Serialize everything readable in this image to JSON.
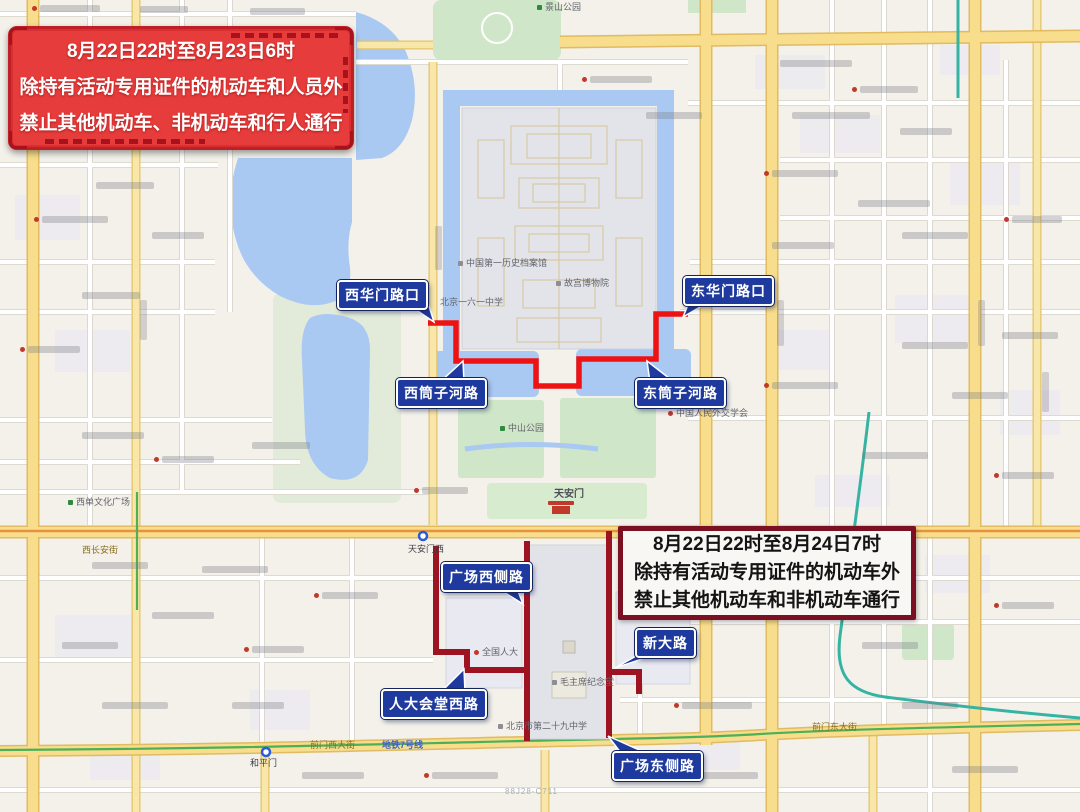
{
  "notices": {
    "red": {
      "line1": "8月22日22时至8月23日6时",
      "line2": "除持有活动专用证件的机动车和人员外",
      "line3": "禁止其他机动车、非机动车和行人通行"
    },
    "maroon": {
      "line1": "8月22日22时至8月24日7时",
      "line2": "除持有活动专用证件的机动车外",
      "line3": "禁止其他机动车和非机动车通行"
    }
  },
  "callouts": {
    "xihuamen": "西华门路口",
    "donghuamen": "东华门路口",
    "xitongzi": "西筒子河路",
    "dongtongzi": "东筒子河路",
    "guangchang_xice": "广场西侧路",
    "rendahuitang_xi": "人大会堂西路",
    "xindalu": "新大路",
    "guangchang_dongce": "广场东侧路"
  },
  "map_labels": {
    "jingshan": "景山公园",
    "zhongshan": "中山公园",
    "palace_museum": "故宫博物院",
    "archives": "中国第一历史档案馆",
    "tiananmen": "天安门",
    "tiananmen_west": "天安门西",
    "school161": "北京一六一中学",
    "west_changan": "西长安街",
    "npc": "全国人大",
    "mao_memorial": "毛主席纪念堂",
    "school29": "北京市第二十九中学",
    "foreign_affairs": "中国人民外交学会",
    "xidan_plaza": "西单文化广场",
    "qianmen_west": "前门西大街",
    "metro_line7": "地铁7号线",
    "qianmen_east": "前门东大街",
    "hepingmen": "和平门",
    "watermark": "88J28-C711"
  },
  "colors": {
    "route_bright_red": "#ef1212",
    "route_dark_red": "#9e1322",
    "callout_blue": "#1e3a9e",
    "notice_red_bg": "#e63c3b",
    "notice_maroon_border": "#7b1023",
    "water": "#a9c9f2",
    "park": "#cfe6c8",
    "artery_yellow": "#f7dd8c"
  }
}
